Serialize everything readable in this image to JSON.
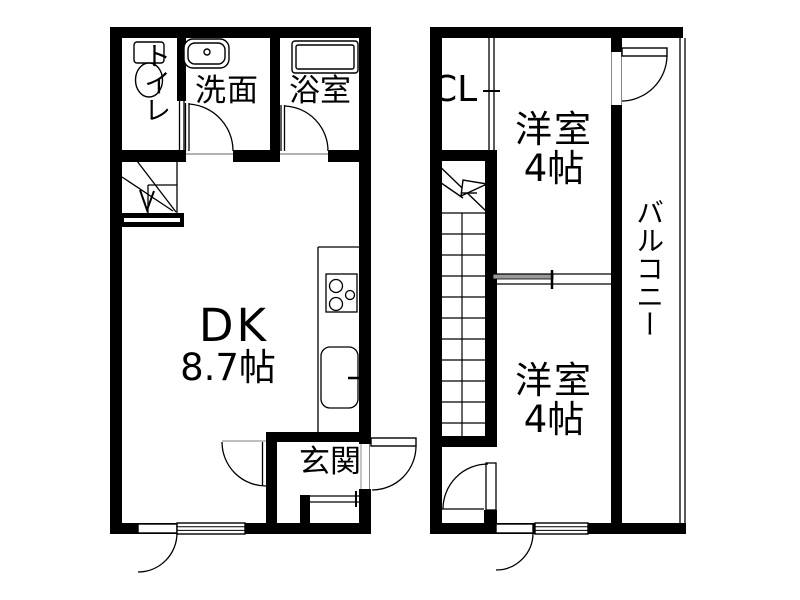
{
  "colors": {
    "line": "#000000",
    "background": "#ffffff",
    "panel_gray": "#999999"
  },
  "floor1": {
    "toilet_label": "トイレ",
    "washroom_label": "洗面",
    "bathroom_label": "浴室",
    "dining_kitchen_label": "DK",
    "dining_kitchen_size": "8.7帖",
    "entrance_label": "玄関"
  },
  "floor2": {
    "closet_label": "CL",
    "room_top_label": "洋室",
    "room_top_size": "4帖",
    "room_bottom_label": "洋室",
    "room_bottom_size": "4帖",
    "balcony_label": "バルコニー"
  }
}
